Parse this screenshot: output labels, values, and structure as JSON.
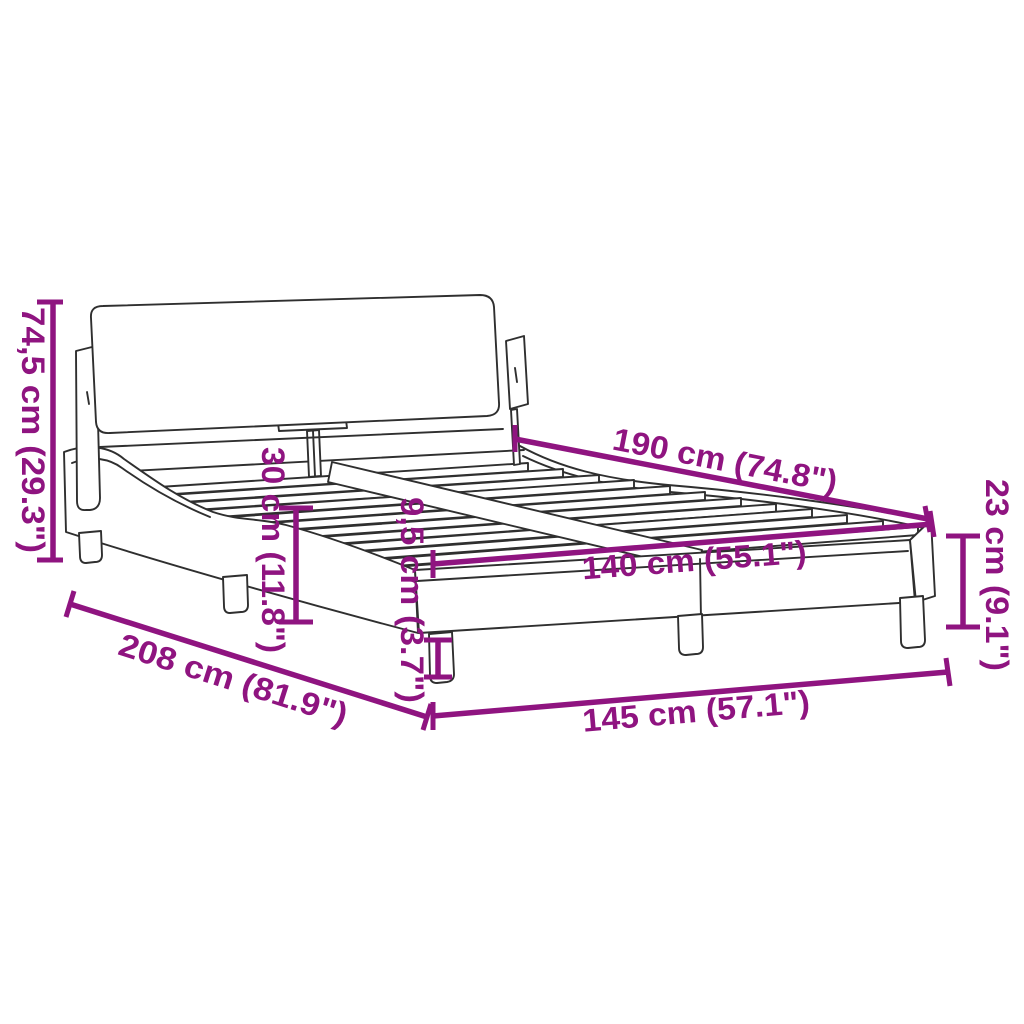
{
  "diagram": {
    "title": "bed frame dimension diagram",
    "background_color": "#ffffff",
    "accent_color": "#8f1480",
    "line_art_color": "#2f2f2f",
    "dimensions": {
      "total_height": {
        "label": "74,5 cm (29.3\")"
      },
      "inner_length": {
        "label": "190 cm (74.8\")"
      },
      "side_rail_height": {
        "label": "30 cm (11.8\")"
      },
      "leg_height": {
        "label": "9,5 cm (3.7\")"
      },
      "inner_width": {
        "label": "140 cm (55.1\")"
      },
      "foot_end_height": {
        "label": "23 cm (9.1\")"
      },
      "total_length": {
        "label": "208 cm (81.9\")"
      },
      "total_width": {
        "label": "145 cm (57.1\")"
      }
    }
  }
}
